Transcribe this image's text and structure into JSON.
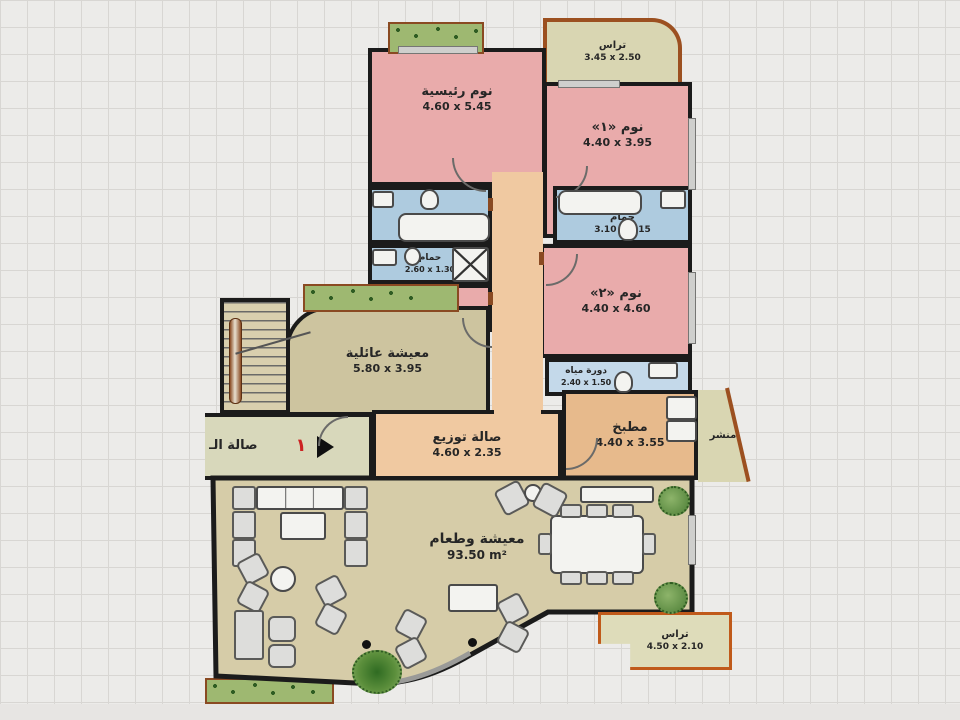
{
  "rooms": {
    "terrace_top": {
      "name": "تراس",
      "dims": "3.45 x 2.50"
    },
    "master_bedroom": {
      "name": "نوم رئيسية",
      "dims": "4.60 x 5.45"
    },
    "bedroom_1": {
      "name": "نوم «١»",
      "dims": "4.40 x 3.95"
    },
    "bathroom_1": {
      "name": "حمام",
      "dims": "3.30 x 2.15"
    },
    "bathroom_2": {
      "name": "حمام",
      "dims": "3.10 x 2.15"
    },
    "bathroom_3": {
      "name": "حمام",
      "dims": "2.60 x 1.30"
    },
    "nanny_room": {
      "name": "مربية",
      "dims": "3.30 x 1.90"
    },
    "bedroom_2": {
      "name": "نوم «٢»",
      "dims": "4.40 x 4.60"
    },
    "wc": {
      "name": "دورة مياه",
      "dims": "2.40 x 1.50"
    },
    "family_living": {
      "name": "معيشة عائلية",
      "dims": "5.80 x 3.95"
    },
    "distribution_hall": {
      "name": "صالة توزيع",
      "dims": "4.60 x 2.35"
    },
    "hall_left": {
      "name": "صالة الـ",
      "dims": ""
    },
    "kitchen": {
      "name": "مطبخ",
      "dims": "4.40 x 3.55"
    },
    "drying": {
      "name": "منشر",
      "dims": ""
    },
    "living_dining": {
      "name": "معيشة وطعام",
      "dims": "93.50 m²"
    },
    "terrace_bottom": {
      "name": "تراس",
      "dims": "4.50 x 2.10"
    }
  },
  "entrance": {
    "number": "١"
  },
  "colors": {
    "bedroom": "#e9abab",
    "bathroom": "#aecbdf",
    "corridor": "#f0c9a1",
    "kitchen": "#e7ba8c",
    "living_dining": "#d6cca8",
    "family_living": "#cdc49f",
    "hall": "#d8d8bb",
    "terrace": "#d9d6b2",
    "planter": "#9eb871",
    "wall": "#1b1b1b",
    "terrace_border": "#b55a1e",
    "entrance_number": "#cc2222"
  }
}
